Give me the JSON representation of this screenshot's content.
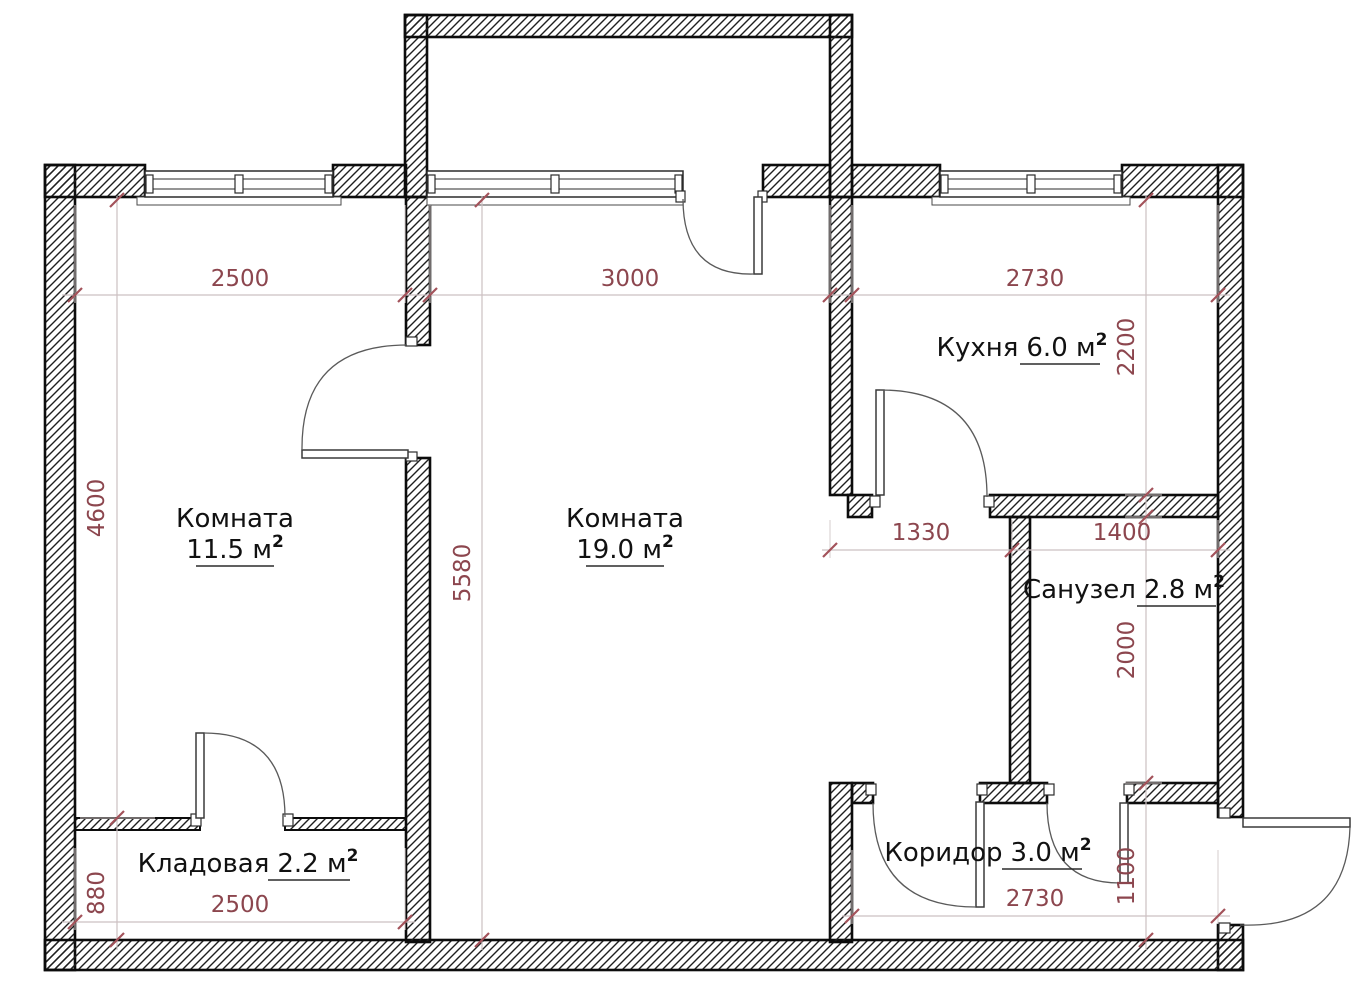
{
  "rooms": {
    "room1": {
      "name": "Комната",
      "area": "11.5 м",
      "sup": "2"
    },
    "room2": {
      "name": "Комната",
      "area": "19.0 м",
      "sup": "2"
    },
    "kitchen": {
      "name": "Кухня",
      "area": "6.0 м",
      "sup": "2"
    },
    "bathroom": {
      "name": "Санузел",
      "area": "2.8 м",
      "sup": "2"
    },
    "storage": {
      "name": "Кладовая",
      "area": "2.2 м",
      "sup": "2"
    },
    "corridor": {
      "name": "Коридор",
      "area": "3.0 м",
      "sup": "2"
    }
  },
  "dimensions": {
    "room1_width": "2500",
    "room2_width": "3000",
    "kitchen_width": "2730",
    "room1_height": "4600",
    "room2_height": "5580",
    "kitchen_height": "2200",
    "passage_width": "1330",
    "bathroom_width": "1400",
    "bathroom_height": "2000",
    "storage_height": "880",
    "storage_width": "2500",
    "corridor_width": "2730",
    "corridor_height": "1100"
  },
  "colors": {
    "dimension_text": "#8c464e",
    "tick": "#a3525a",
    "dim_line": "#ccc0c2",
    "wall_outline": "#0c0c0c"
  }
}
